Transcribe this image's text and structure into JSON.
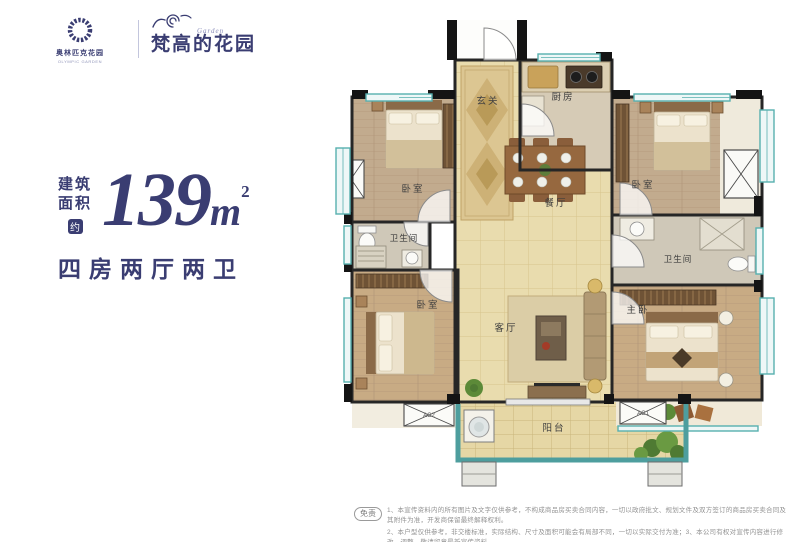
{
  "brand": {
    "logo_text": "奥林匹克花园",
    "logo_subtext": "OLYMPIC GARDEN",
    "name": "梵高的花园",
    "script": "Garden"
  },
  "area": {
    "label_top": "建筑",
    "label_bottom": "面积",
    "approx": "约",
    "value": "139",
    "unit": "m",
    "unit_sup": "2",
    "layout": "四房两厅两卫"
  },
  "plan": {
    "rooms": {
      "entry": "玄关",
      "kitchen": "厨房",
      "bedroom_top_left": "卧室",
      "bedroom_top_right": "卧室",
      "bedroom_bottom_left": "卧室",
      "master": "主卧",
      "dining": "餐厅",
      "living": "客厅",
      "bath_left": "卫生间",
      "bath_right": "卫生间",
      "balcony": "阳台",
      "ac_left": "AC2",
      "ac_right": "AC1"
    }
  },
  "disclaimer": {
    "badge": "免责",
    "line1": "1、本宣传资料内的所有图片及文字仅供参考，不构成商品房买卖合同内容，一切以政府批文、规划文件及双方签订的商品房买卖合同及其附件为准，开发商保留最终解释权利。",
    "line2": "2、本户型仅供参考，非交楼标准，实际结构、尺寸及面积可能会有局部不同，一切以实际交付为准；3、本公司有权对宣传内容进行修改、调整，敬请留意最新宣传资料。"
  },
  "colors": {
    "accent": "#3a3d72",
    "wall": "#1c1c1c",
    "window_teal": "#57b0af",
    "tile_floor": "#e9dcae",
    "wood_floor": "#c6a98a",
    "balcony_frame": "#4e9e9e"
  }
}
